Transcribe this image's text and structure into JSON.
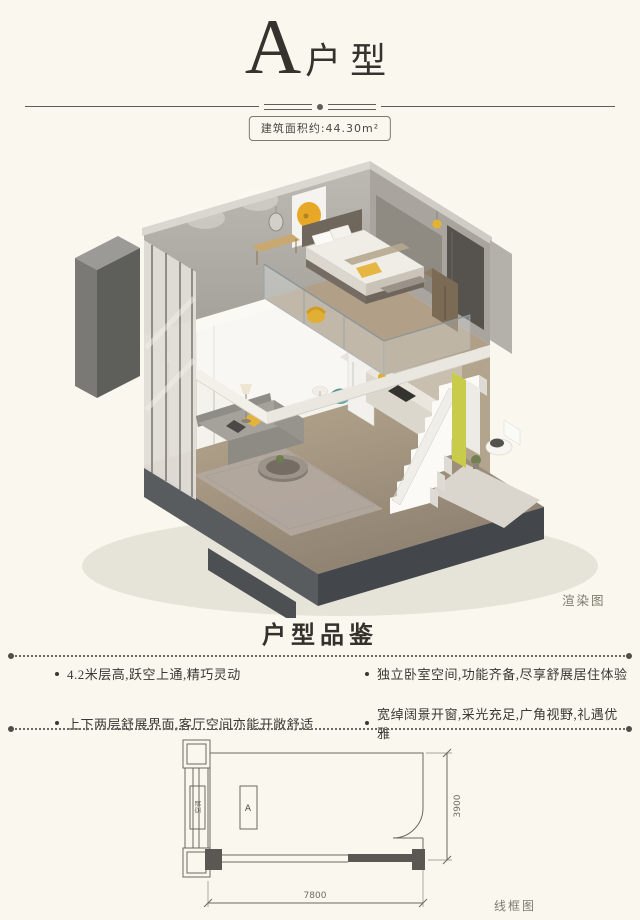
{
  "header": {
    "title_letter": "A",
    "title_suffix": "户型",
    "area_badge": "建筑面积约:44.30m²"
  },
  "render": {
    "caption": "渲染图",
    "description": "loft-apartment-cutaway-isometric-render"
  },
  "features": {
    "section_title": "户型品鉴",
    "items": [
      {
        "label": "4.2米层高,跃空上通,精巧灵动"
      },
      {
        "label": "独立卧室空间,功能齐备,尽享舒展居住体验"
      },
      {
        "label": "上下两层舒展界面,客厅空间亦能开敞舒适"
      },
      {
        "label": "宽绰阔景开窗,采光充足,广角视野,礼遇优雅"
      }
    ]
  },
  "floorplan": {
    "caption": "线框图",
    "room_label": "A",
    "side_label": "空调",
    "dim_width": "7800",
    "dim_depth": "3900"
  },
  "colors": {
    "background": "#faf7ee",
    "accent_yellow": "#e3b23a",
    "slab_dark": "#4b4e50",
    "wall_gray": "#aeaaa4",
    "line": "#55534f"
  }
}
